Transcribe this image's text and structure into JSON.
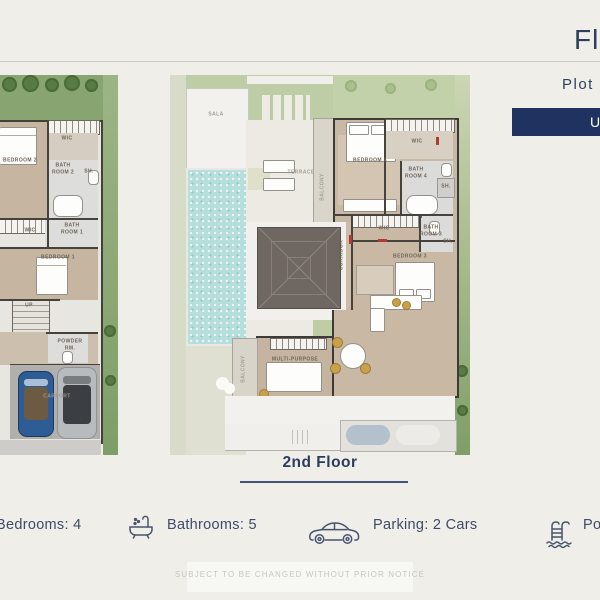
{
  "colors": {
    "accent_navy": "#20325f",
    "text_navy": "#2f3e5e",
    "pool_blue": "#b6dfdc",
    "lawn_green": "#87a471",
    "wood_floor": "#c7b6a1"
  },
  "header": {
    "title": "Fl",
    "plot_label": "Plot",
    "button_label": "U"
  },
  "floorplans": {
    "left": {
      "labels": [
        {
          "t": "BEDROOM 2",
          "x": 20,
          "y": 86
        },
        {
          "t": "WIC",
          "x": 67,
          "y": 64
        },
        {
          "t": "BATH ROOM 2",
          "x": 63,
          "y": 94,
          "w": 24
        },
        {
          "t": "SH.",
          "x": 89,
          "y": 97
        },
        {
          "t": "WIC",
          "x": 30,
          "y": 156
        },
        {
          "t": "BATH ROOM 1",
          "x": 72,
          "y": 154,
          "w": 24
        },
        {
          "t": "BEDROOM 1",
          "x": 58,
          "y": 183
        },
        {
          "t": "UP",
          "x": 29,
          "y": 231
        },
        {
          "t": "POWDER RM.",
          "x": 70,
          "y": 270,
          "w": 30
        },
        {
          "t": "CARPORT",
          "x": 57,
          "y": 322,
          "c": "faint"
        }
      ]
    },
    "center": {
      "caption": "2nd Floor",
      "labels": [
        {
          "t": "SALA",
          "x": 46,
          "y": 40,
          "c": "lt"
        },
        {
          "t": "TERRACE",
          "x": 131,
          "y": 98,
          "c": "lt"
        },
        {
          "t": "BALCONY",
          "x": 153,
          "y": 112,
          "v": 1,
          "c": "lt"
        },
        {
          "t": "BEDROOM 4",
          "x": 200,
          "y": 86
        },
        {
          "t": "WIC",
          "x": 247,
          "y": 67
        },
        {
          "t": "BATH ROOM 4",
          "x": 246,
          "y": 98,
          "w": 24
        },
        {
          "t": "SH.",
          "x": 276,
          "y": 112
        },
        {
          "t": "WIC",
          "x": 214,
          "y": 154
        },
        {
          "t": "BATH ROOM 3",
          "x": 261,
          "y": 156,
          "w": 24
        },
        {
          "t": "SH.",
          "x": 278,
          "y": 167
        },
        {
          "t": "CORRIDOR",
          "x": 172,
          "y": 180,
          "v": 1
        },
        {
          "t": "BEDROOM 3",
          "x": 240,
          "y": 182
        },
        {
          "t": "MULTI-PURPOSE",
          "x": 125,
          "y": 285
        },
        {
          "t": "BALCONY",
          "x": 74,
          "y": 294,
          "v": 1,
          "c": "lt"
        }
      ]
    }
  },
  "footer": {
    "stats": [
      {
        "icon": "",
        "text": "Bedrooms:  4"
      },
      {
        "icon": "bathtub-icon",
        "text": "Bathrooms:  5"
      },
      {
        "icon": "car-icon",
        "text": "Parking:  2 Cars"
      },
      {
        "icon": "pool-ladder-icon",
        "text": "Poo"
      }
    ],
    "disclaimer": "SUBJECT TO BE CHANGED WITHOUT PRIOR NOTICE"
  }
}
